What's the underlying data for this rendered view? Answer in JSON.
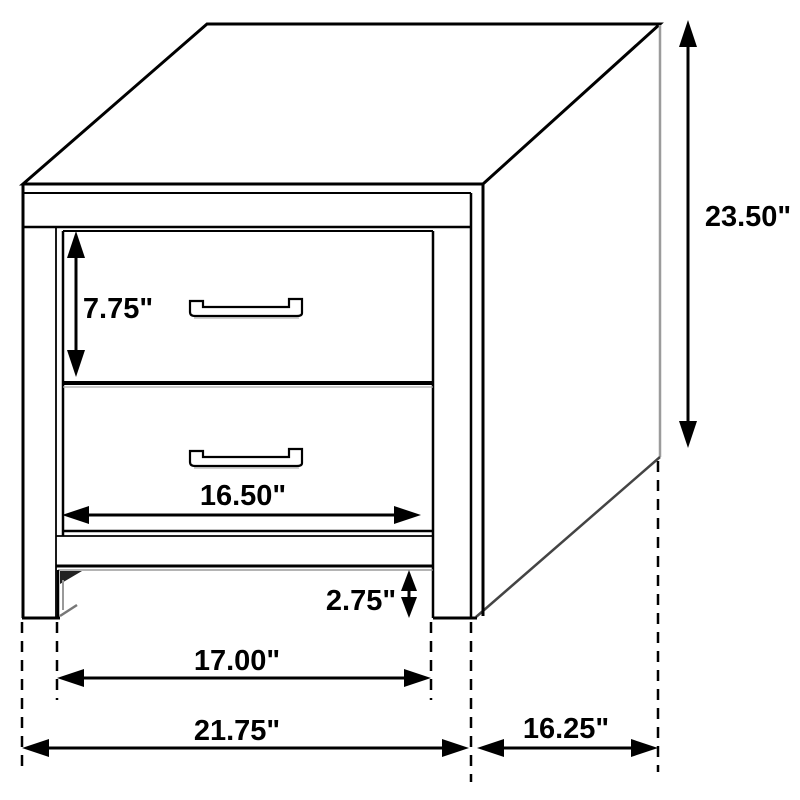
{
  "page": {
    "background": "#ffffff"
  },
  "diagram": {
    "line_color": "#000000",
    "shadow_color": "#999999",
    "unit": "inches",
    "labels": {
      "drawer_height": "7.75\"",
      "overall_height": "23.50\"",
      "drawer_width": "16.50\"",
      "floor_clearance": "2.75\"",
      "leg_span": "17.00\"",
      "overall_width": "21.75\"",
      "overall_depth": "16.25\""
    }
  }
}
